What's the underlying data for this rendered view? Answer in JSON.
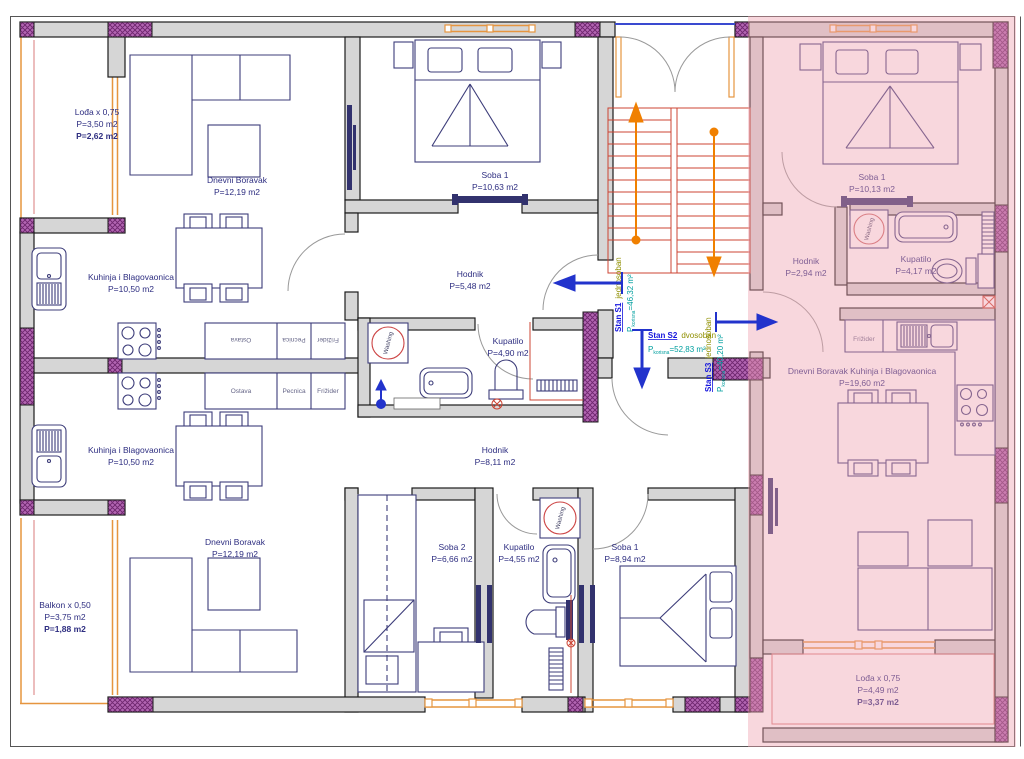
{
  "title": "Apartment floor plan",
  "colors": {
    "wall_fill": "#d6d6d6",
    "wall_stroke": "#1b1b1b",
    "column_purple": "#a254a2",
    "window_orange": "#e6953f",
    "furniture_navy": "#3d3d7a",
    "label_navy": "#2d2d80",
    "stair_red": "#cc4433",
    "flow_orange": "#f08000",
    "arrow_blue": "#2233cc",
    "unit_link_blue": "#1515dd",
    "unit_type_olive": "#8f8f00",
    "unit_area_teal": "#009f9f",
    "highlight_pink": "#ef9fae"
  },
  "units": {
    "s1": {
      "id": "Stan S1",
      "type": "jednosoban",
      "p_label": "P",
      "p_sub": "korisna",
      "p_value": "=46,32 m²"
    },
    "s2": {
      "id": "Stan S2",
      "type": "dvosoban",
      "p_label": "P",
      "p_sub": "korisna",
      "p_value": "=52,83 m²"
    },
    "s3": {
      "id": "Stan S3",
      "type": "jednosoban",
      "p_label": "P",
      "p_sub": "korisna",
      "p_value": "=40,20 m²"
    }
  },
  "rooms": {
    "loda_top": {
      "l1": "Lođa x 0,75",
      "l2": "P=3,50 m2",
      "l3": "P=2,62 m2"
    },
    "dnevni_top": {
      "l1": "Dnevni Boravak",
      "l2": "P=12,19 m2"
    },
    "soba1_top": {
      "l1": "Soba 1",
      "l2": "P=10,63 m2"
    },
    "kuhinja_top": {
      "l1": "Kuhinja i Blagovaonica",
      "l2": "P=10,50 m2"
    },
    "hodnik_top": {
      "l1": "Hodnik",
      "l2": "P=5,48 m2"
    },
    "kupatilo_top": {
      "l1": "Kupatilo",
      "l2": "P=4,90 m2"
    },
    "kuhinja_bottom": {
      "l1": "Kuhinja i Blagovaonica",
      "l2": "P=10,50 m2"
    },
    "hodnik_bottom": {
      "l1": "Hodnik",
      "l2": "P=8,11 m2"
    },
    "soba2_bottom": {
      "l1": "Soba 2",
      "l2": "P=6,66 m2"
    },
    "kupatilo_bottom": {
      "l1": "Kupatilo",
      "l2": "P=4,55 m2"
    },
    "soba1_bottom": {
      "l1": "Soba 1",
      "l2": "P=8,94 m2"
    },
    "dnevni_bottom": {
      "l1": "Dnevni Boravak",
      "l2": "P=12,19 m2"
    },
    "balkon": {
      "l1": "Balkon x 0,50",
      "l2": "P=3,75 m2",
      "l3": "P=1,88 m2"
    },
    "pink_soba1": {
      "l1": "Soba 1",
      "l2": "P=10,13 m2"
    },
    "pink_hodnik": {
      "l1": "Hodnik",
      "l2": "P=2,94 m2"
    },
    "pink_kupatilo": {
      "l1": "Kupatilo",
      "l2": "P=4,17 m2"
    },
    "pink_dnevni": {
      "l1": "Dnevni Boravak Kuhinja i Blagovaonica",
      "l2": "P=19,60 m2"
    },
    "pink_loda": {
      "l1": "Lođa x 0,75",
      "l2": "P=4,49 m2",
      "l3": "P=3,37 m2"
    }
  },
  "kitchen_cells": {
    "c1": "Ostava",
    "c2": "Pecnica",
    "c3": "Frižider"
  },
  "pink_kitchen": {
    "fridge": "Frižider"
  },
  "appliance": {
    "washing": "Washing"
  }
}
